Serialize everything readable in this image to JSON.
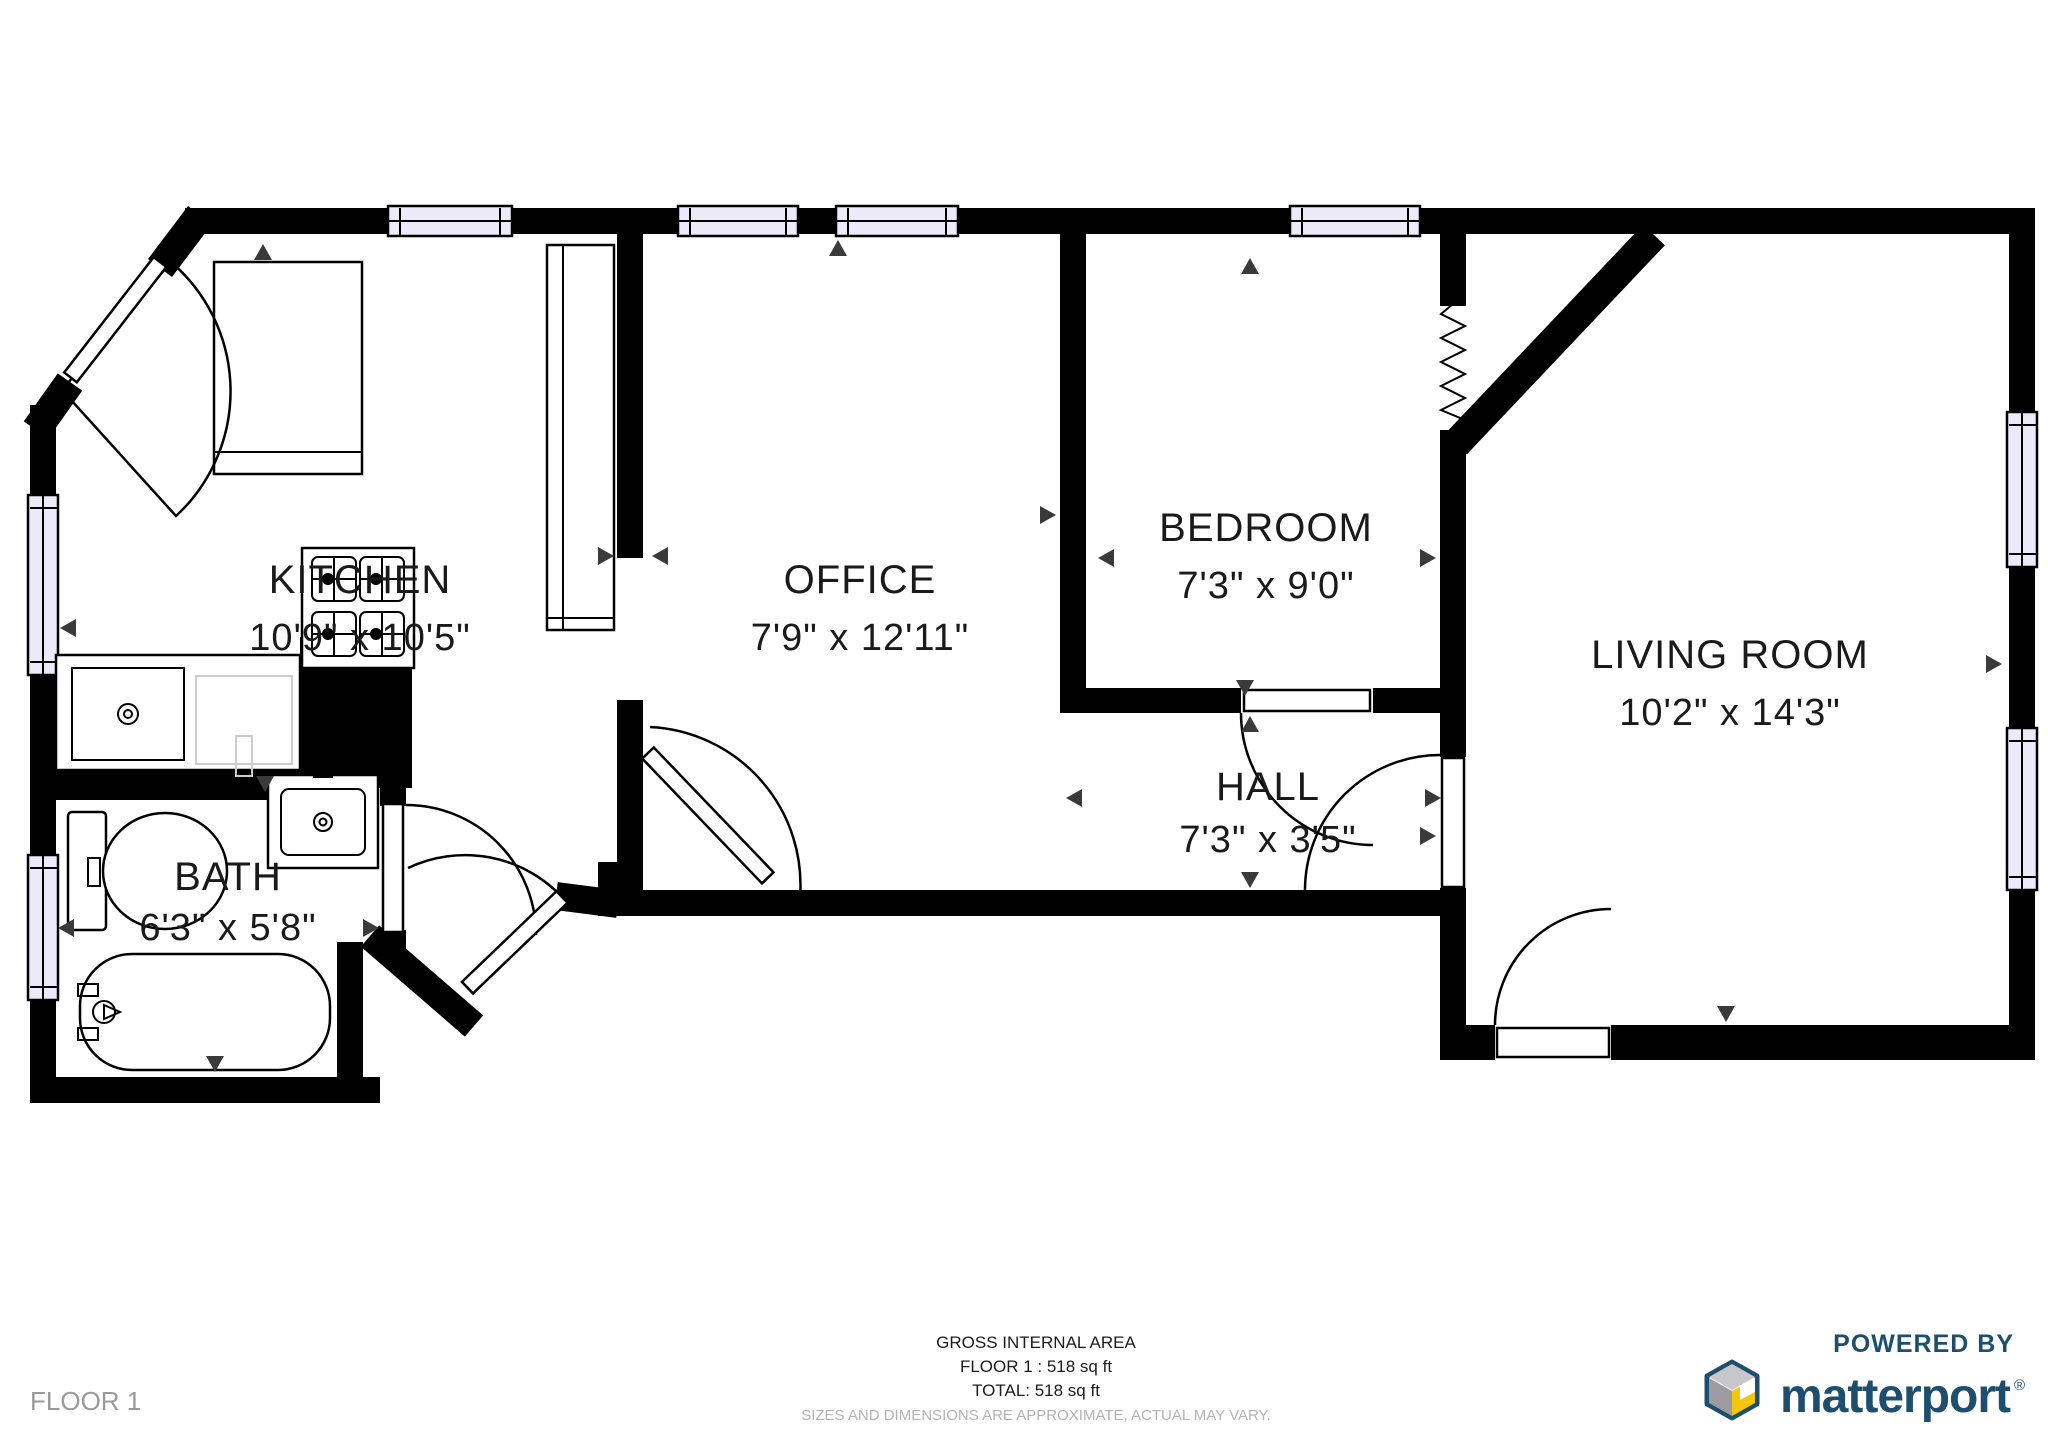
{
  "plan": {
    "rooms": {
      "kitchen": {
        "name": "KITCHEN",
        "dims": "10'9\" x 10'5\""
      },
      "office": {
        "name": "OFFICE",
        "dims": "7'9\" x 12'11\""
      },
      "bedroom": {
        "name": "BEDROOM",
        "dims": "7'3\" x 9'0\""
      },
      "living_room": {
        "name": "LIVING ROOM",
        "dims": "10'2\" x 14'3\""
      },
      "hall": {
        "name": "HALL",
        "dims": "7'3\" x 3'5\""
      },
      "bath": {
        "name": "BATH",
        "dims": "6'3\" x 5'8\""
      }
    },
    "fixtures": [
      "stove-icon",
      "kitchen-sink-icon",
      "wardrobe-icon",
      "counter-icon",
      "toilet-icon",
      "bath-sink-icon",
      "bathtub-icon",
      "window-icon",
      "door-arc-icon",
      "zigzag-opening-icon",
      "direction-marker-icon"
    ]
  },
  "footer": {
    "gross_line": "GROSS INTERNAL AREA",
    "floor_line": "FLOOR 1 : 518 sq ft",
    "total_line": "TOTAL: 518 sq ft",
    "disclaimer": "SIZES AND DIMENSIONS ARE APPROXIMATE, ACTUAL MAY VARY.",
    "floor_label": "FLOOR 1"
  },
  "logo": {
    "powered_by": "POWERED BY",
    "brand": "matterport",
    "registered": "®"
  },
  "colors": {
    "wall": "#000000",
    "window_fill": "#eceaf8",
    "brand_navy": "#1d4e6e",
    "brand_yellow": "#f5c70a",
    "muted_text": "#9a9a9a",
    "disclaimer_text": "#b3b3b3"
  }
}
